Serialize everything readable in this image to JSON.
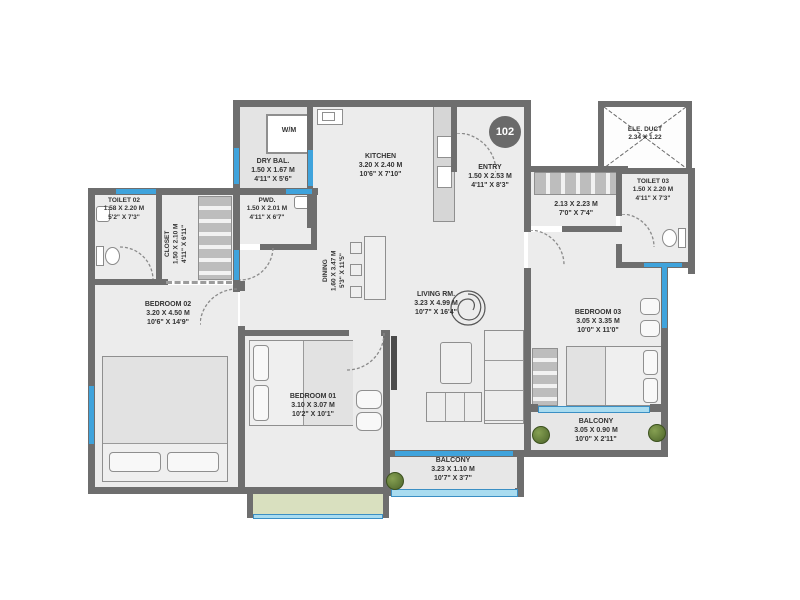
{
  "unit_number": "102",
  "rooms": {
    "wm": {
      "name": "W/M"
    },
    "dry_bal": {
      "name": "DRY BAL.",
      "metric": "1.50 X 1.67 M",
      "imperial": "4'11\" X 5'6\""
    },
    "kitchen": {
      "name": "KITCHEN",
      "metric": "3.20 X 2.40 M",
      "imperial": "10'6\" X 7'10\""
    },
    "entry": {
      "name": "ENTRY",
      "metric": "1.50 X 2.53 M",
      "imperial": "4'11\" X 8'3\""
    },
    "ele_duct": {
      "name": "ELE. DUCT",
      "metric": "2.34 X 1.22"
    },
    "passage": {
      "metric": "2.13 X 2.23 M",
      "imperial": "7'0\" X 7'4\""
    },
    "toilet_03": {
      "name": "TOILET 03",
      "metric": "1.50 X 2.20 M",
      "imperial": "4'11\" X 7'3\""
    },
    "toilet_02": {
      "name": "TOILET 02",
      "metric": "1.58 X 2.20 M",
      "imperial": "5'2\" X 7'3\""
    },
    "closet": {
      "name": "CLOSET",
      "metric": "1.50 X 2.10 M",
      "imperial": "4'11\" X 6'11\""
    },
    "pwd": {
      "name": "PWD.",
      "metric": "1.50 X 2.01 M",
      "imperial": "4'11\" X 6'7\""
    },
    "dining": {
      "name": "DINING",
      "metric": "1.60 X 3.47 M",
      "imperial": "5'3\" X 11'5\""
    },
    "living": {
      "name": "LIVING RM.",
      "metric": "3.23 X 4.99 M",
      "imperial": "10'7\" X 16'4\""
    },
    "bedroom_01": {
      "name": "BEDROOM 01",
      "metric": "3.10 X 3.07 M",
      "imperial": "10'2\" X 10'1\""
    },
    "bedroom_02": {
      "name": "BEDROOM 02",
      "metric": "3.20 X 4.50 M",
      "imperial": "10'6\" X 14'9\""
    },
    "bedroom_03": {
      "name": "BEDROOM 03",
      "metric": "3.05 X 3.35 M",
      "imperial": "10'0\" X 11'0\""
    },
    "balcony_living": {
      "name": "BALCONY",
      "metric": "3.23 X 1.10 M",
      "imperial": "10'7\" X 3'7\""
    },
    "balcony_bed03": {
      "name": "BALCONY",
      "metric": "3.05 X 0.90 M",
      "imperial": "10'0\" X 2'11\""
    }
  },
  "colors": {
    "wall": "#6e6e6e",
    "floor": "#ececec",
    "window_blue": "#3fa3dc",
    "balcony_rail": "#a9dcf0",
    "green_deck": "#d9e0bf",
    "plant": "#5d7a33"
  }
}
